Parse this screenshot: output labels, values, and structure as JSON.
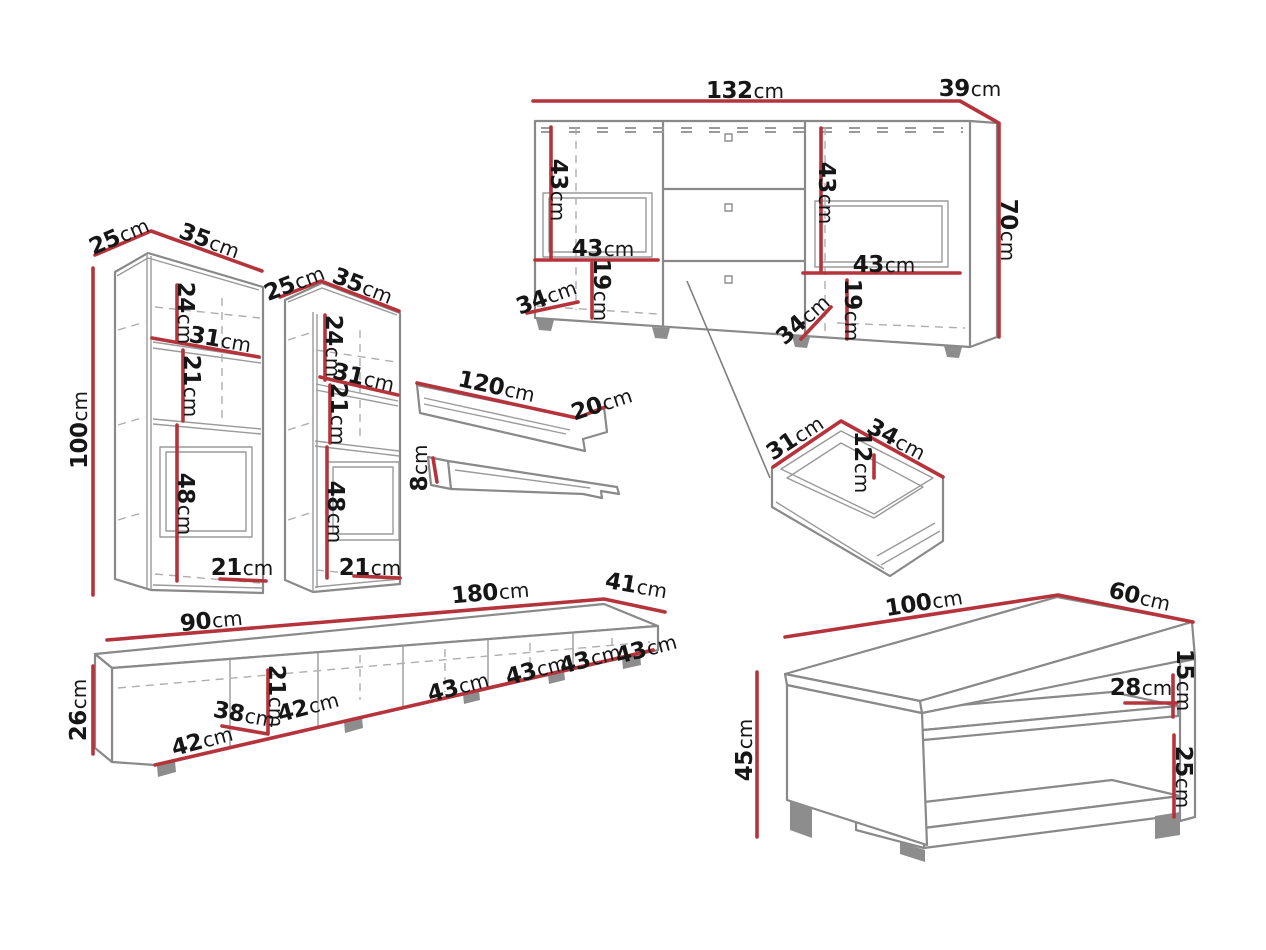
{
  "unit": "cm",
  "palette": {
    "dimension_line": "#b5343c",
    "outline": "#898989",
    "label_text": "#161616",
    "background": "#ffffff"
  },
  "pieces": {
    "sideboard": {
      "labels": {
        "width": "132",
        "depth": "39",
        "height": "70",
        "left_inner_height": "43",
        "left_shelf_width": "43",
        "left_base_height": "19",
        "left_base_depth": "34",
        "right_inner_height": "43",
        "right_shelf_width": "43",
        "right_base_height": "19",
        "right_base_depth": "34"
      }
    },
    "tall_cabinet_left": {
      "labels": {
        "depth": "25",
        "width": "35",
        "height": "100",
        "top_section_height": "24",
        "shelf_width": "31",
        "middle_section_height": "21",
        "lower_section_height": "48",
        "base_width": "21"
      }
    },
    "tall_cabinet_right": {
      "labels": {
        "depth": "25",
        "width": "35",
        "top_section_height": "24",
        "shelf_width": "31",
        "middle_section_height": "21",
        "lower_section_height": "48",
        "base_width": "21"
      }
    },
    "wall_shelf": {
      "labels": {
        "length": "120",
        "depth": "20",
        "height": "8"
      }
    },
    "drawer": {
      "labels": {
        "depth": "31",
        "width": "34",
        "height": "12"
      }
    },
    "tv_stand": {
      "labels": {
        "left_section_width": "90",
        "right_section_width": "180",
        "depth": "41",
        "height": "26",
        "compartment_width_a": "42",
        "compartment_depth": "38",
        "compartment_height": "21",
        "compartment_width_b": "42",
        "door_width_1": "43",
        "door_width_2": "43",
        "door_width_3": "43",
        "door_width_4": "43"
      }
    },
    "coffee_table": {
      "labels": {
        "width": "100",
        "depth": "60",
        "height": "45",
        "top_clearance": "15",
        "shelf_inset": "28",
        "bottom_clearance": "25"
      }
    }
  }
}
